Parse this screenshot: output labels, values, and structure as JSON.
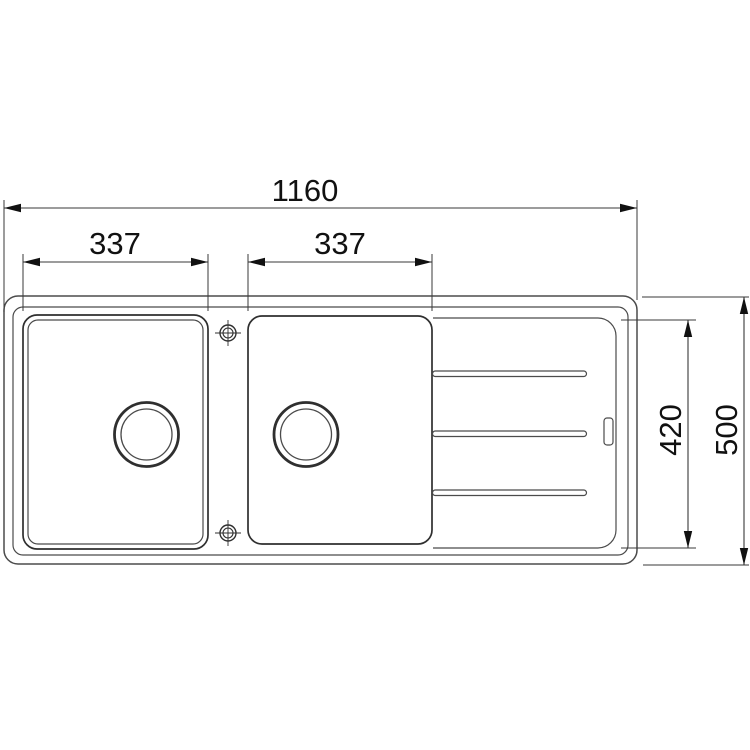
{
  "diagram": {
    "dimension_labels": {
      "overall_width": "1160",
      "left_bowl_width": "337",
      "right_bowl_width": "337",
      "inner_depth": "420",
      "overall_depth": "500"
    },
    "colors": {
      "background": "#ffffff",
      "outline": "#4b4b4b",
      "bowl_outline": "#2f2f2f",
      "dimension_line": "#3a3a3a",
      "text": "#111111"
    }
  }
}
